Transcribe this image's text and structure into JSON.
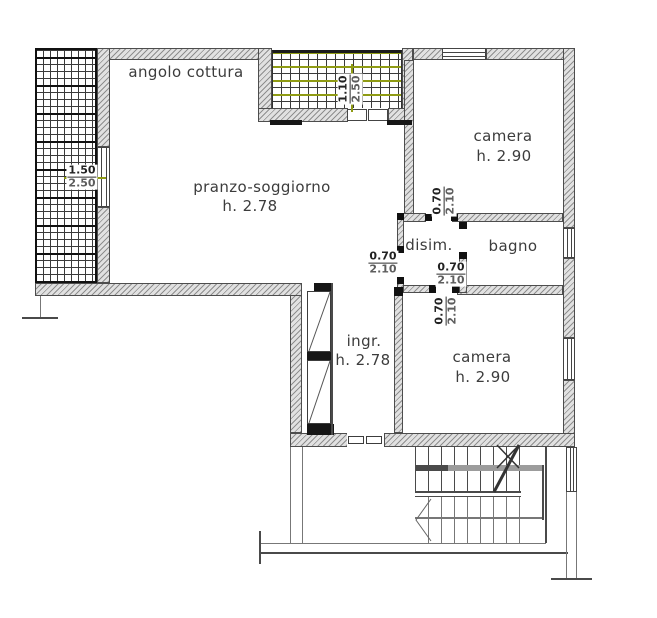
{
  "plan_title": "floor-plan",
  "rooms": {
    "kitchen": {
      "label": "angolo cottura"
    },
    "living": {
      "label": "pranzo-soggiorno",
      "height": "h. 2.78"
    },
    "bedroom_north": {
      "label": "camera",
      "height": "h. 2.90"
    },
    "hall": {
      "label": "disim."
    },
    "bath": {
      "label": "bagno"
    },
    "entry": {
      "label": "ingr.",
      "height": "h. 2.78"
    },
    "bedroom_south": {
      "label": "camera",
      "height": "h. 2.90"
    }
  },
  "dims": {
    "balcony_west_door": {
      "w": "1.50",
      "h": "2.50"
    },
    "balcony_north_door": {
      "w": "1.10",
      "h": "2.50"
    },
    "door_hall_west": {
      "w": "0.70",
      "h": "2.10"
    },
    "door_bath": {
      "w": "0.70",
      "h": "2.10"
    },
    "door_bedroom_north": {
      "w": "0.70",
      "h": "2.10"
    },
    "door_bedroom_south": {
      "w": "0.70",
      "h": "2.10"
    }
  },
  "colors": {
    "wall_fill": "#e1e1e1",
    "wall_hatch": "#8e8e8e",
    "line": "#4a4a4a",
    "accent_olive": "#8f9b14",
    "text": "#3c3c3c"
  }
}
